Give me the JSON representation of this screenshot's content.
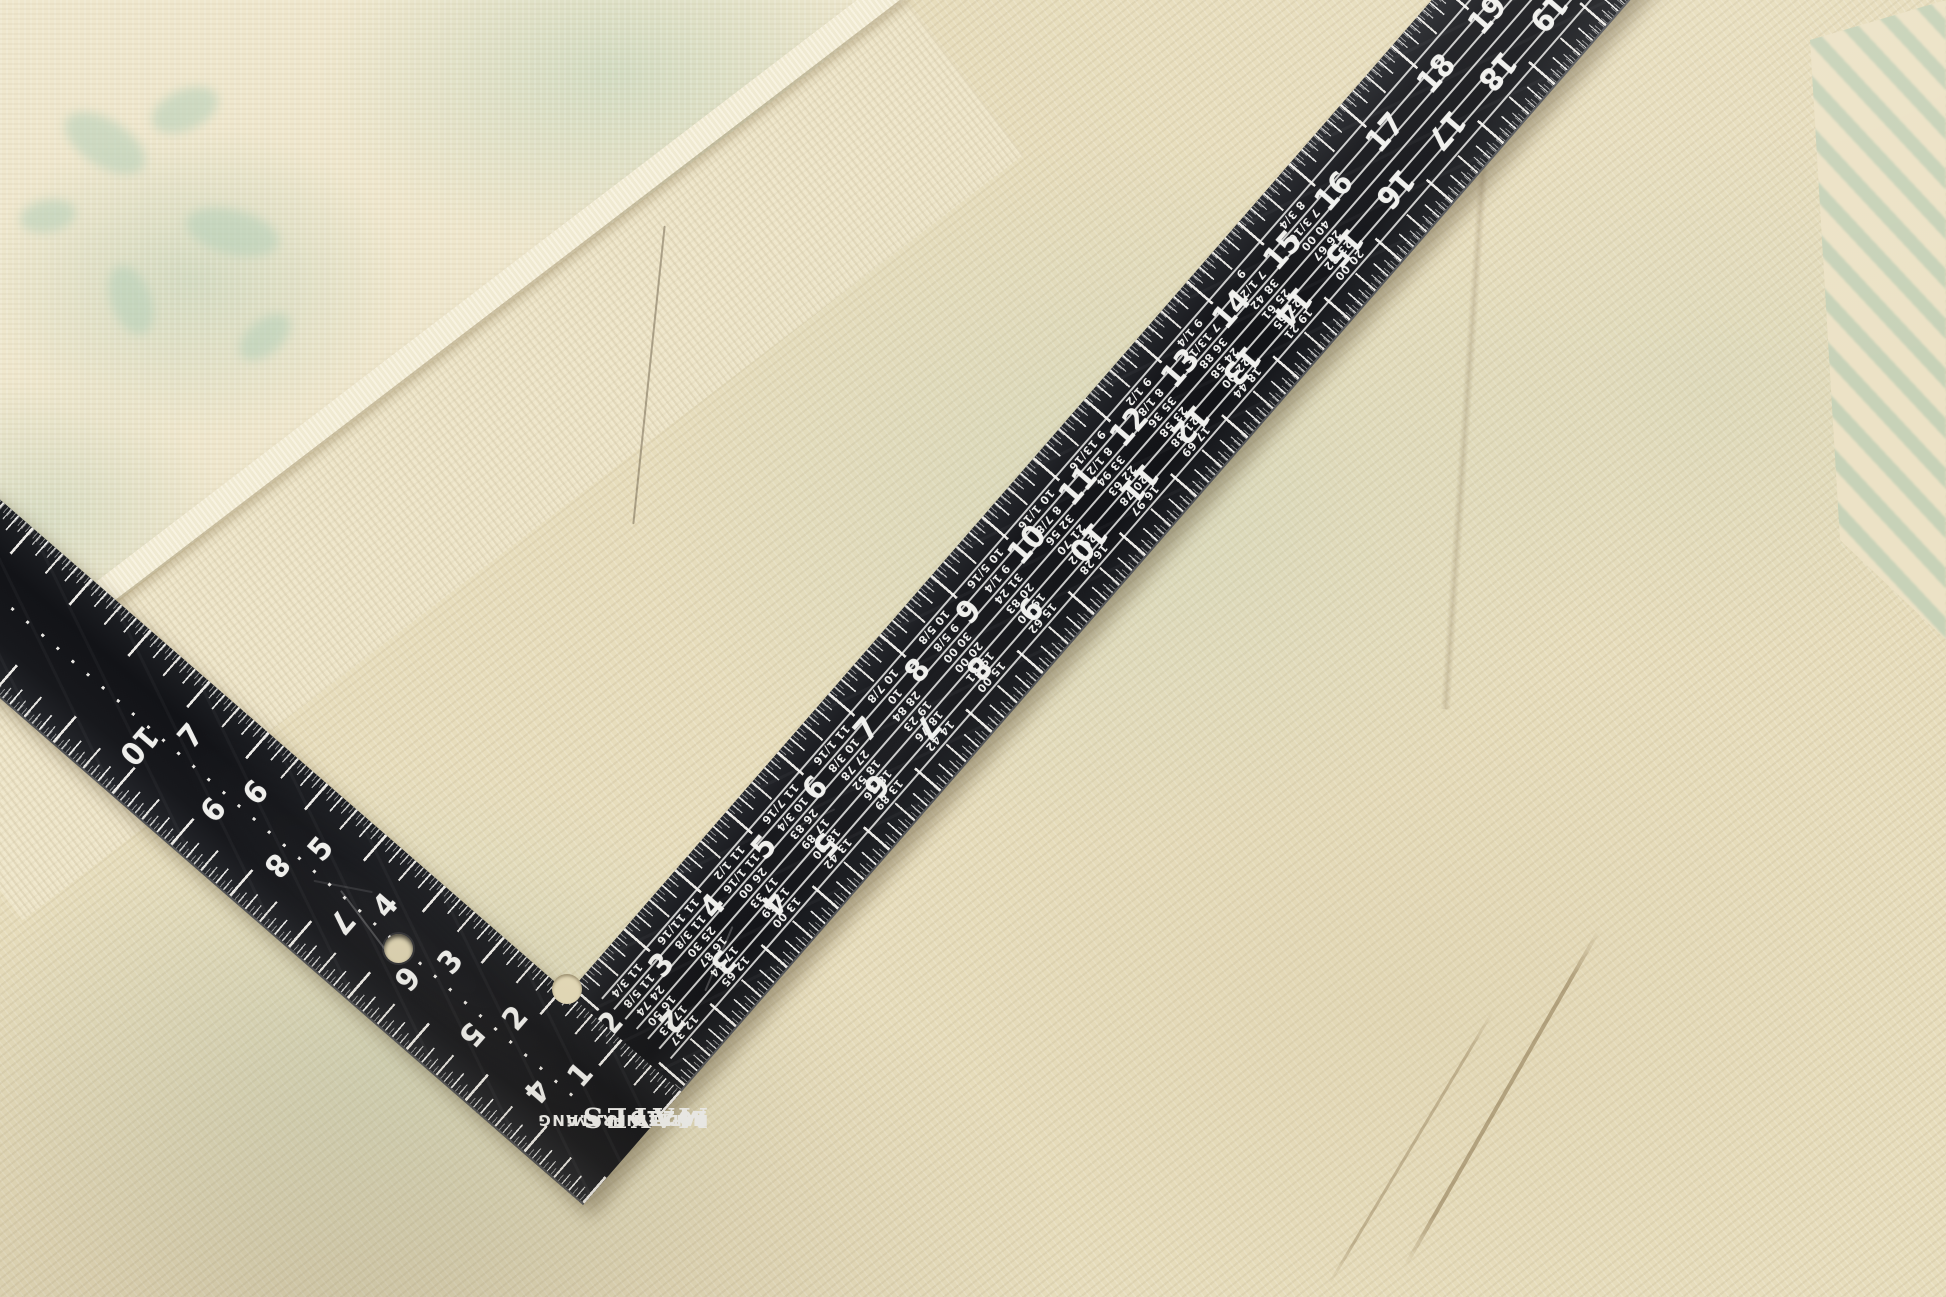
{
  "photo": {
    "subject": "black L-shaped carpenter framing square lying on a cream vintage rug",
    "colors": {
      "rug_base": "#e7ddbc",
      "rug_pile": "#efe7cd",
      "rug_mint": "#b4cfb8",
      "fringe": "#f4eed9",
      "square_black": "#17181c",
      "markings_white": "#efefec",
      "streak_brown": "#8a744e"
    }
  },
  "brand": {
    "logo": "MAYES",
    "line1": "RAFTER-FRAMiNG",
    "line2": "MADE IN U.S.A",
    "model": "10219"
  },
  "square": {
    "body_scale_top": [
      "1",
      "2",
      "3",
      "4",
      "5",
      "6",
      "7",
      "8",
      "9",
      "10",
      "11",
      "12",
      "13",
      "14",
      "15",
      "16",
      "17",
      "18",
      "19",
      "20",
      "21",
      "22"
    ],
    "body_scale_bottom": [
      "1",
      "2",
      "3",
      "4",
      "5",
      "6",
      "7",
      "8",
      "9",
      "10",
      "11",
      "12",
      "13",
      "14",
      "15",
      "16",
      "17",
      "18",
      "19",
      "20",
      "21",
      "22"
    ],
    "tongue_scale_inner": [
      "1",
      "2",
      "3",
      "4",
      "5",
      "6",
      "7"
    ],
    "tongue_scale_outer": [
      "4",
      "5",
      "6",
      "7",
      "8",
      "9",
      "10"
    ],
    "rafter_table": {
      "row_labels": [
        "SIDE CUT HIP OR VALLEY USE",
        "SIDE CUT OF JACKS USE",
        "DIFF IN LENGTH OF JACKS 2 FEET CENTERS",
        "DIFF IN LENGTH OF JACKS 16 INCHES CENTERS",
        "LENGTH HIP OR VALLEY PER FOOT RUN",
        "LENGTH COMMON RAFTERS PER FOOT RUN"
      ],
      "columns": [
        {
          "inch": 2,
          "side_cut_hip": "11 13/16",
          "side_cut_jacks": "11 13/16",
          "jacks_2ft": "24 33",
          "jacks_16in": "16 22",
          "hip_valley": "17 09",
          "common": "12 16"
        },
        {
          "inch": 3,
          "side_cut_hip": "11 3/4",
          "side_cut_jacks": "11 5/8",
          "jacks_2ft": "24 74",
          "jacks_16in": "16 50",
          "hip_valley": "17 23",
          "common": "12 37"
        },
        {
          "inch": 4,
          "side_cut_hip": "11 11/16",
          "side_cut_jacks": "11 3/8",
          "jacks_2ft": "25 30",
          "jacks_16in": "16 87",
          "hip_valley": "17 44",
          "common": "12 65"
        },
        {
          "inch": 5,
          "side_cut_hip": "11 1/2",
          "side_cut_jacks": "11 1/16",
          "jacks_2ft": "26 00",
          "jacks_16in": "17 33",
          "hip_valley": "17 69",
          "common": "13 00"
        },
        {
          "inch": 6,
          "side_cut_hip": "11 7/16",
          "side_cut_jacks": "10 3/4",
          "jacks_2ft": "26 83",
          "jacks_16in": "17 89",
          "hip_valley": "18 00",
          "common": "13 42"
        },
        {
          "inch": 7,
          "side_cut_hip": "11 1/16",
          "side_cut_jacks": "10 3/8",
          "jacks_2ft": "27 78",
          "jacks_16in": "18 52",
          "hip_valley": "18 36",
          "common": "13 89"
        },
        {
          "inch": 8,
          "side_cut_hip": "10 7/8",
          "side_cut_jacks": "10",
          "jacks_2ft": "28 84",
          "jacks_16in": "19 23",
          "hip_valley": "18 76",
          "common": "14 42"
        },
        {
          "inch": 9,
          "side_cut_hip": "10 5/8",
          "side_cut_jacks": "9 5/8",
          "jacks_2ft": "30 00",
          "jacks_16in": "20 00",
          "hip_valley": "19 21",
          "common": "15 00"
        },
        {
          "inch": 10,
          "side_cut_hip": "10 5/16",
          "side_cut_jacks": "9 1/4",
          "jacks_2ft": "31 24",
          "jacks_16in": "20 83",
          "hip_valley": "19 70",
          "common": "15 62"
        },
        {
          "inch": 11,
          "side_cut_hip": "10 1/16",
          "side_cut_jacks": "8 7/8",
          "jacks_2ft": "32 56",
          "jacks_16in": "21 70",
          "hip_valley": "20 22",
          "common": "16 28"
        },
        {
          "inch": 12,
          "side_cut_hip": "9 13/16",
          "side_cut_jacks": "8 1/2",
          "jacks_2ft": "33 94",
          "jacks_16in": "22 63",
          "hip_valley": "20 78",
          "common": "16 97"
        },
        {
          "inch": 13,
          "side_cut_hip": "9 1/2",
          "side_cut_jacks": "8 1/8",
          "jacks_2ft": "35 36",
          "jacks_16in": "23 58",
          "hip_valley": "21 38",
          "common": "17 69"
        },
        {
          "inch": 14,
          "side_cut_hip": "9 1/4",
          "side_cut_jacks": "7 13/16",
          "jacks_2ft": "36 88",
          "jacks_16in": "24 58",
          "hip_valley": "22 00",
          "common": "18 44"
        },
        {
          "inch": 15,
          "side_cut_hip": "9",
          "side_cut_jacks": "7 1/2",
          "jacks_2ft": "38 42",
          "jacks_16in": "25 61",
          "hip_valley": "22 65",
          "common": "19 21"
        },
        {
          "inch": 16,
          "side_cut_hip": "8 3/4",
          "side_cut_jacks": "7 3/16",
          "jacks_2ft": "40 00",
          "jacks_16in": "26 67",
          "hip_valley": "23 32",
          "common": "20 00"
        }
      ]
    }
  },
  "layout_hints": {
    "heel_corner_xy": [
      583,
      1205
    ],
    "body_angle_deg": -49,
    "tongue_angle_deg": -139,
    "pixels_per_inch_body": 78,
    "pixels_per_inch_tongue": 86
  }
}
